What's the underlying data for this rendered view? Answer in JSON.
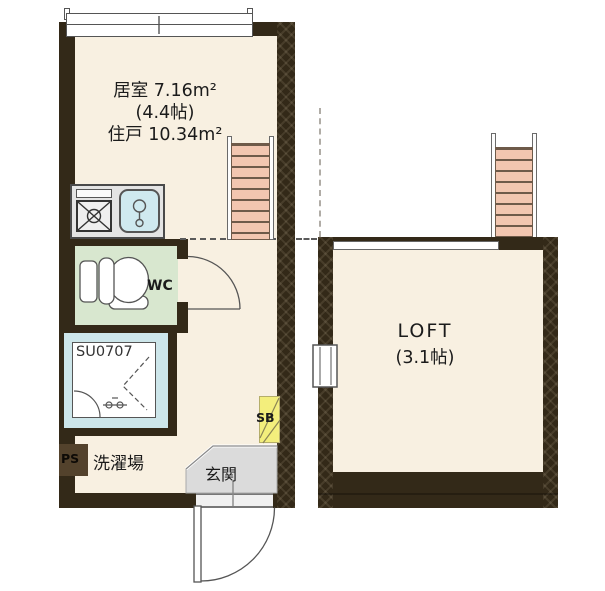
{
  "main_unit": {
    "room_label": "居室 7.16m²",
    "room_size": "(4.4帖)",
    "unit_label": "住戸 10.34m²",
    "wc_label": "WC",
    "bath_unit_label": "SU0707",
    "laundry_label": "洗濯場",
    "entrance_label": "玄関",
    "pipe_space_label": "PS",
    "shoe_cabinet_label": "SB"
  },
  "loft": {
    "label": "LOFT",
    "size_label": "(3.1帖)"
  },
  "colors": {
    "wall": "#332918",
    "floor": "#f8f0e1",
    "wc_floor": "#d8e7cf",
    "bath_floor": "#cde6ea",
    "entrance_floor": "#dbdbdb",
    "ladder": "#f2c6b0",
    "shoe_cabinet": "#f3ee7c"
  }
}
